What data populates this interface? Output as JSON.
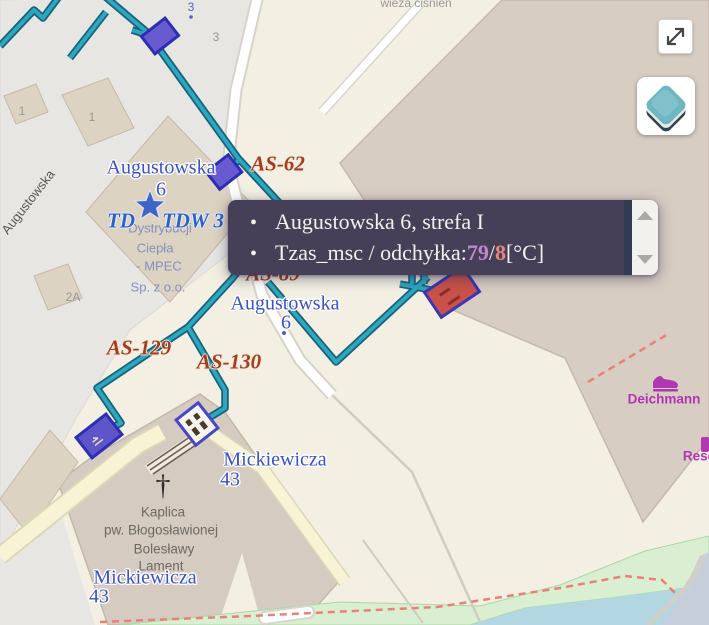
{
  "tooltip": {
    "bullet": "•",
    "line1": "Augustowska 6, strefa I",
    "line2": {
      "prefix": "Tzas_msc / odchyłka: ",
      "value1": "79",
      "separator": " / ",
      "value2": "8",
      "suffix": " [°C]"
    },
    "colors": {
      "background": "#454058",
      "text": "#f3f1ec",
      "value1": "#c487ce",
      "value2": "#e8857d"
    }
  },
  "controls": {
    "expand_button": {
      "icon": "expand-diagonal-icon"
    },
    "layers_button": {
      "icon": "layers-icon"
    }
  },
  "map_colors": {
    "base": "#f3efe3",
    "retail_area": "#e7e6e3",
    "large_building": "#d7cdc3",
    "small_building": "#ddd3c2",
    "pipeline": "#2da7bd",
    "pipeline_casing": "#19607b",
    "marker_purple": "#5d55c9",
    "marker_red": "#c8524a",
    "marker_border": "#2e2eb5",
    "water": "#b2d6e2",
    "green_area": "#daefd2",
    "path_red_dashed": "#ea8076",
    "footway_yellow": "#f7f3d4"
  },
  "map_labels": [
    {
      "name": "street-label-augustowska",
      "t": "Augustowska",
      "x": 28,
      "y": 202,
      "cls": "L-street",
      "rot": -52
    },
    {
      "name": "poi-label-mpec-line1",
      "t": "Dystrybucji",
      "x": 160,
      "y": 228,
      "cls": "L-poi"
    },
    {
      "name": "poi-label-mpec-line2",
      "t": "Ciepła",
      "x": 155,
      "y": 248,
      "cls": "L-poi"
    },
    {
      "name": "poi-label-mpec-line3",
      "t": "- MPEC",
      "x": 159,
      "y": 266,
      "cls": "L-poi"
    },
    {
      "name": "poi-label-mpec-line4",
      "t": "Sp. z o.o.",
      "x": 158,
      "y": 287,
      "cls": "L-poi"
    },
    {
      "name": "node-label-td",
      "t": "TD",
      "x": 121,
      "y": 221,
      "cls": "L-td"
    },
    {
      "name": "node-label-tdw3",
      "t": "TDW 3",
      "x": 193,
      "y": 221,
      "cls": "L-td"
    },
    {
      "name": "poi-label-water-tower",
      "t": "wieża ciśnień",
      "x": 416,
      "y": 3,
      "cls": "L-grey"
    },
    {
      "name": "housenumber-3-blue",
      "t": "3",
      "x": 191,
      "y": 7,
      "cls": "L-hn"
    },
    {
      "name": "housenumber-3-grey",
      "t": "3",
      "x": 216,
      "y": 37,
      "cls": "L-grey"
    },
    {
      "name": "housenumber-1a",
      "t": "1",
      "x": 22,
      "y": 111,
      "cls": "L-grey"
    },
    {
      "name": "housenumber-1b",
      "t": "1",
      "x": 92,
      "y": 117,
      "cls": "L-grey"
    },
    {
      "name": "housenumber-2a",
      "t": "2A",
      "x": 73,
      "y": 297,
      "cls": "L-grey"
    },
    {
      "name": "chapel-cross",
      "t": "†",
      "x": 163,
      "y": 486,
      "cls": "L-cross"
    },
    {
      "name": "poi-label-chapel-line1",
      "t": "Kaplica",
      "x": 163,
      "y": 512,
      "cls": "L-kap"
    },
    {
      "name": "poi-label-chapel-line2",
      "t": "pw. Błogosławionej",
      "x": 161,
      "y": 530,
      "cls": "L-kap"
    },
    {
      "name": "poi-label-chapel-line3",
      "t": "Bolesławy",
      "x": 164,
      "y": 549,
      "cls": "L-kap"
    },
    {
      "name": "poi-label-chapel-line4",
      "t": "Lament",
      "x": 161,
      "y": 566,
      "cls": "L-kap"
    },
    {
      "name": "node-label-as62",
      "t": "AS-62",
      "x": 278,
      "y": 164,
      "cls": "L-node"
    },
    {
      "name": "node-label-as129",
      "t": "AS-129",
      "x": 139,
      "y": 348,
      "cls": "L-node"
    },
    {
      "name": "node-label-as130",
      "t": "AS-130",
      "x": 229,
      "y": 362,
      "cls": "L-node"
    },
    {
      "name": "node-label-as89",
      "t": "AS-89",
      "x": 273,
      "y": 274,
      "cls": "L-node"
    },
    {
      "name": "addr-label-augustowska6-top",
      "t": "Augustowska",
      "x": 161,
      "y": 168,
      "cls": "L-addr"
    },
    {
      "name": "addr-label-augustowska6-top-num",
      "t": "6",
      "x": 161,
      "y": 190,
      "cls": "L-addr"
    },
    {
      "name": "addr-label-augustowska6-mid",
      "t": "Augustowska",
      "x": 285,
      "y": 304,
      "cls": "L-addr"
    },
    {
      "name": "addr-label-augustowska6-mid-num",
      "t": "6",
      "x": 286,
      "y": 323,
      "cls": "L-addr"
    },
    {
      "name": "addr-label-mickiewicza43-a",
      "t": "Mickiewicza",
      "x": 275,
      "y": 460,
      "cls": "L-addr"
    },
    {
      "name": "addr-label-mickiewicza43-a-num",
      "t": "43",
      "x": 230,
      "y": 480,
      "cls": "L-addr"
    },
    {
      "name": "addr-label-mickiewicza43-b",
      "t": "Mickiewicza",
      "x": 145,
      "y": 578,
      "cls": "L-addr"
    },
    {
      "name": "addr-label-mickiewicza43-b-num",
      "t": "43",
      "x": 99,
      "y": 597,
      "cls": "L-addr"
    },
    {
      "name": "shop-label-deichmann",
      "t": "Deichmann",
      "x": 664,
      "y": 399,
      "cls": "L-shop"
    },
    {
      "name": "shop-label-reserved",
      "t": "Rese",
      "x": 699,
      "y": 456,
      "cls": "L-shop"
    }
  ]
}
